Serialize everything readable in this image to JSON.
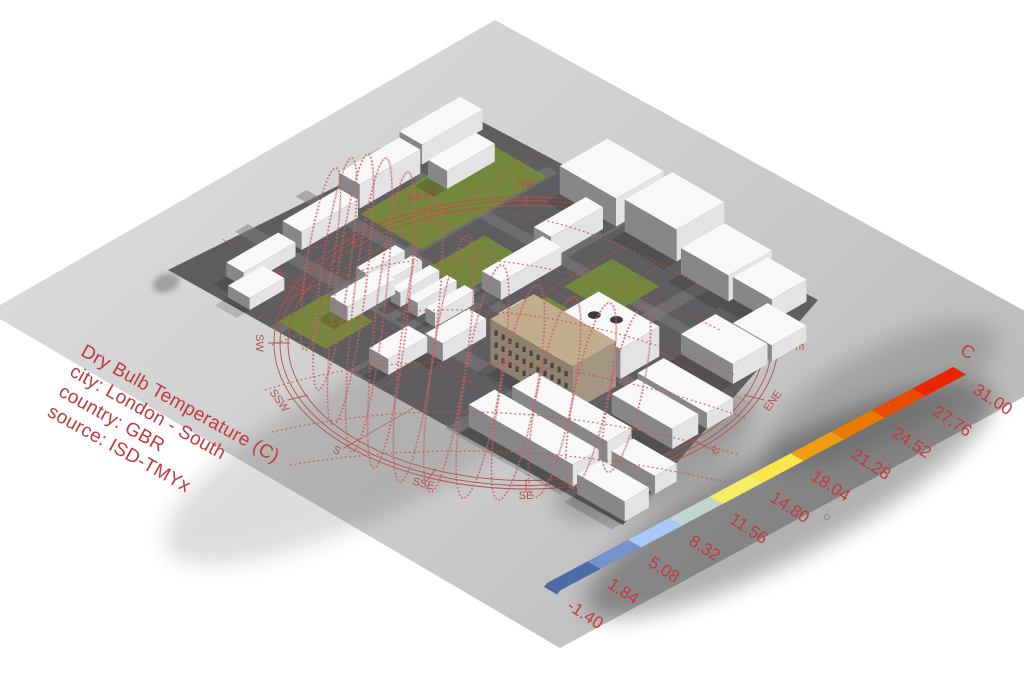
{
  "title_block": {
    "lines": [
      "Dry Bulb Temperature (C)",
      "city: London - South",
      "country: GBR",
      "source: ISD-TMYx"
    ],
    "color": "#c03a3a"
  },
  "legend": {
    "unit": "C",
    "labels_top_to_bottom": [
      "31.00",
      "27.76",
      "24.52",
      "21.28",
      "18.04",
      "14.80",
      "11.56",
      "8.32",
      "5.08",
      "1.84",
      "-1.40"
    ],
    "segment_colors_bottom_to_top": [
      "#4b6ba9",
      "#7393ca",
      "#aac8f7",
      "#c1d5d0",
      "#f5ef67",
      "#fce64a",
      "#ef9c15",
      "#ea7b00",
      "#ea4a00",
      "#ea2600"
    ],
    "text_color": "#c23a3a",
    "geometry": {
      "x0": 547,
      "y0": 583,
      "dx": 40.6,
      "dy": -21.6,
      "wx": 13,
      "wy": 7.5
    }
  },
  "compass": {
    "labels": [
      "N",
      "NNE",
      "NE",
      "ENE",
      "E",
      "ESE",
      "SE",
      "SSE",
      "S",
      "SSW",
      "SW",
      "WSW",
      "W",
      "WNW",
      "NW",
      "NNW"
    ],
    "center": [
      526,
      343
    ],
    "rings": [
      [
        252,
        146
      ],
      [
        246,
        142.5
      ],
      [
        238,
        137.5
      ]
    ],
    "label_radius": [
      270,
      156
    ],
    "color": "#b5504c"
  },
  "scene": {
    "colors": {
      "plane_light": "#d8d8d8",
      "plane_dark": "#bcbcbc",
      "site": "#5e5e60",
      "road": "#7d7d80",
      "green": "#75873c",
      "roof_white": "#f8f8f8",
      "face_sw": "#87878a",
      "face_se": "#e3e3e5",
      "tan_top": "#c2ad8e",
      "tan_sw": "#8f8170",
      "tan_se": "#a39582",
      "window": "#38332c",
      "sun_red": "#c4504e",
      "bead_red": "#ce7272"
    },
    "plane": [
      [
        -12,
        312
      ],
      [
        495,
        20
      ],
      [
        1103,
        354
      ],
      [
        560,
        648
      ]
    ],
    "site": [
      [
        168,
        270
      ],
      [
        475,
        118
      ],
      [
        818,
        300
      ],
      [
        623,
        525
      ]
    ],
    "roads_plan": [
      [
        75,
        0,
        15,
        470
      ],
      [
        145,
        0,
        13,
        460
      ],
      [
        230,
        0,
        12,
        420
      ],
      [
        0,
        115,
        320,
        13
      ],
      [
        0,
        205,
        315,
        13
      ],
      [
        0,
        318,
        290,
        14
      ]
    ],
    "greens_plan": [
      [
        165,
        55,
        145,
        70
      ],
      [
        150,
        148,
        65,
        45
      ],
      [
        138,
        245,
        52,
        30
      ],
      [
        10,
        115,
        55,
        55
      ],
      [
        210,
        245,
        55,
        55
      ]
    ],
    "lines_plan": [
      [
        0,
        100,
        330,
        100
      ],
      [
        0,
        240,
        320,
        240
      ],
      [
        0,
        380,
        300,
        380
      ],
      [
        60,
        0,
        60,
        500
      ],
      [
        200,
        0,
        200,
        470
      ]
    ],
    "buildings": [
      {
        "u": 25,
        "v": 40,
        "lu": 60,
        "lv": 20,
        "h": 14
      },
      {
        "u": 95,
        "v": 35,
        "lu": 65,
        "lv": 22,
        "h": 18
      },
      {
        "u": 170,
        "v": 25,
        "lu": 70,
        "lv": 24,
        "h": 24
      },
      {
        "u": 250,
        "v": 15,
        "lu": 70,
        "lv": 26,
        "h": 20
      },
      {
        "u": 240,
        "v": 58,
        "lu": 55,
        "lv": 22,
        "h": 18
      },
      {
        "u": 5,
        "v": 62,
        "lu": 40,
        "lv": 25,
        "h": 12
      },
      {
        "u": 50,
        "v": 135,
        "lu": 55,
        "lv": 20,
        "h": 15
      },
      {
        "u": 300,
        "v": 150,
        "lu": 55,
        "lv": 65,
        "h": 28
      },
      {
        "u": 300,
        "v": 225,
        "lu": 55,
        "lv": 60,
        "h": 32
      },
      {
        "u": 290,
        "v": 300,
        "lu": 50,
        "lv": 55,
        "h": 26
      },
      {
        "u": 295,
        "v": 355,
        "lu": 40,
        "lv": 45,
        "h": 22
      },
      {
        "u": 255,
        "v": 395,
        "lu": 40,
        "lv": 45,
        "h": 16
      },
      {
        "u": 210,
        "v": 380,
        "lu": 40,
        "lv": 60,
        "h": 20
      },
      {
        "u": 160,
        "v": 200,
        "lu": 70,
        "lv": 22,
        "h": 18
      },
      {
        "u": 230,
        "v": 190,
        "lu": 60,
        "lv": 20,
        "h": 22
      },
      {
        "u": 20,
        "v": 210,
        "lu": 45,
        "lv": 22,
        "h": 16
      },
      {
        "u": 65,
        "v": 230,
        "lu": 50,
        "lv": 20,
        "h": 18
      },
      {
        "u": 95,
        "v": 120,
        "lu": 45,
        "lv": 11,
        "h": 14
      },
      {
        "u": 95,
        "v": 140,
        "lu": 45,
        "lv": 11,
        "h": 14
      },
      {
        "u": 95,
        "v": 160,
        "lu": 45,
        "lv": 11,
        "h": 14
      },
      {
        "u": 95,
        "v": 180,
        "lu": 45,
        "lv": 11,
        "h": 14
      },
      {
        "u": 95,
        "v": 200,
        "lu": 45,
        "lv": 11,
        "h": 14
      },
      {
        "u": 92,
        "v": 288,
        "lu": 28,
        "lv": 38,
        "h": 54,
        "k": "w"
      },
      {
        "u": 90,
        "v": 280,
        "lu": 50,
        "lv": 95,
        "h": 45,
        "k": "tan"
      },
      {
        "u": 150,
        "v": 300,
        "lu": 45,
        "lv": 70,
        "h": 30,
        "k": "circ"
      },
      {
        "u": 15,
        "v": 330,
        "lu": 30,
        "lv": 120,
        "h": 22
      },
      {
        "u": 55,
        "v": 340,
        "lu": 28,
        "lv": 110,
        "h": 25
      },
      {
        "u": 10,
        "v": 460,
        "lu": 28,
        "lv": 55,
        "h": 20
      },
      {
        "u": 55,
        "v": 455,
        "lu": 25,
        "lv": 50,
        "h": 18
      },
      {
        "u": 150,
        "v": 390,
        "lu": 30,
        "lv": 80,
        "h": 16
      },
      {
        "u": 110,
        "v": 400,
        "lu": 30,
        "lv": 70,
        "h": 20
      }
    ],
    "loops": [
      [
        336,
        168,
        305,
        350,
        13
      ],
      [
        352,
        158,
        318,
        390,
        14
      ],
      [
        368,
        154,
        333,
        425,
        15
      ],
      [
        386,
        158,
        352,
        452,
        16
      ],
      [
        408,
        172,
        374,
        468,
        16
      ],
      [
        436,
        200,
        400,
        482,
        17
      ],
      [
        468,
        235,
        430,
        492,
        17
      ],
      [
        502,
        265,
        463,
        498,
        18
      ],
      [
        538,
        285,
        498,
        500,
        18
      ],
      [
        574,
        297,
        535,
        497,
        18
      ],
      [
        610,
        303,
        572,
        488,
        17
      ],
      [
        645,
        306,
        608,
        472,
        16
      ]
    ],
    "sweeps": [
      "M300,258 Q470,150 700,286",
      "M285,300 Q465,205 720,330",
      "M272,345 Q470,262 735,375",
      "M265,390 Q480,322 745,418",
      "M272,432 Q490,382 740,455",
      "M290,465 Q500,430 725,482"
    ],
    "shadows": [
      {
        "cx": 380,
        "cy": 440,
        "rx": 240,
        "ry": 70,
        "rot": -27,
        "op": 0.13
      },
      {
        "cx": 655,
        "cy": 455,
        "rx": 110,
        "ry": 45,
        "rot": -28,
        "op": 0.2
      },
      {
        "cx": 790,
        "cy": 500,
        "rx": 230,
        "ry": 55,
        "rot": -28,
        "op": 0.3
      },
      {
        "cx": 880,
        "cy": 395,
        "rx": 130,
        "ry": 45,
        "rot": -28,
        "op": 0.15
      },
      {
        "cx": 166,
        "cy": 283,
        "rx": 14,
        "ry": 9,
        "rot": -20,
        "op": 0.25
      }
    ],
    "artifact_dot": {
      "x": 827,
      "y": 517,
      "r": 2.5
    }
  }
}
